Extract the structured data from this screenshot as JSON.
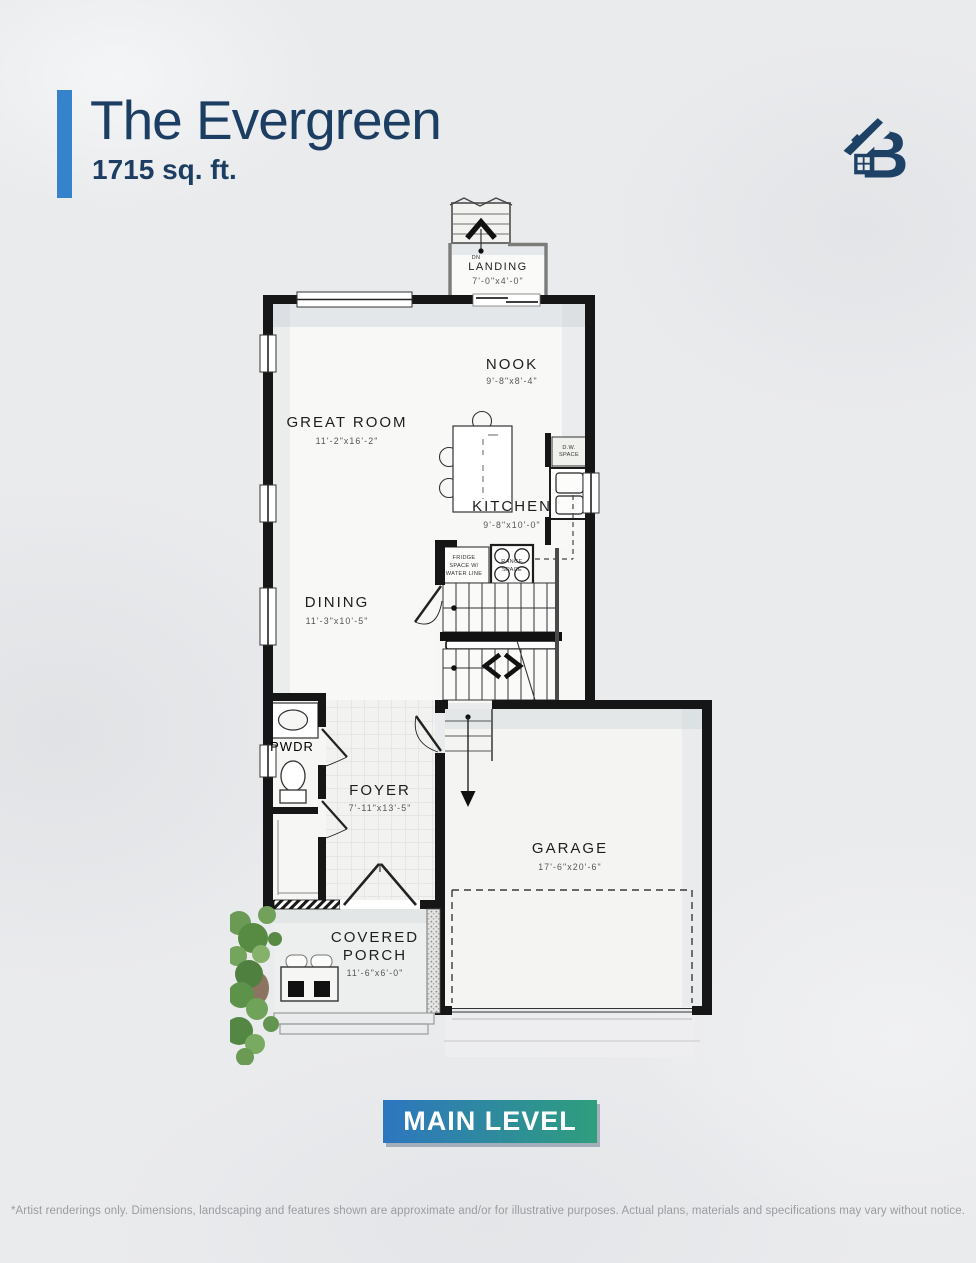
{
  "header": {
    "title": "The Evergreen",
    "sqft": "1715 sq. ft."
  },
  "logo": {
    "letter": "B",
    "description": "house-roof-b-logo"
  },
  "plan": {
    "rooms": {
      "landing": {
        "name": "LANDING",
        "dims": "7'-0\"x4'-0\""
      },
      "nook": {
        "name": "NOOK",
        "dims": "9'-8\"x8'-4\""
      },
      "great_room": {
        "name": "GREAT ROOM",
        "dims": "11'-2\"x16'-2\""
      },
      "kitchen": {
        "name": "KITCHEN",
        "dims": "9'-8\"x10'-0\""
      },
      "dining": {
        "name": "DINING",
        "dims": "11'-3\"x10'-5\""
      },
      "pwdr": {
        "name": "PWDR"
      },
      "foyer": {
        "name": "FOYER",
        "dims": "7'-11\"x13'-5\""
      },
      "garage": {
        "name": "GARAGE",
        "dims": "17'-6\"x20'-6\""
      },
      "covered_porch": {
        "line1": "COVERED",
        "line2": "PORCH",
        "dims": "11'-6\"x6'-0\""
      }
    },
    "annotations": {
      "dn": "DN",
      "dw_line1": "D.W.",
      "dw_line2": "SPACE",
      "fridge_line1": "FRIDGE",
      "fridge_line2": "SPACE W/",
      "fridge_line3": "WATER LINE",
      "range_line1": "RANGE",
      "range_line2": "SPACE"
    }
  },
  "badge": {
    "label": "MAIN LEVEL"
  },
  "footer": {
    "disclaimer": "*Artist renderings only. Dimensions, landscaping and features shown are approximate and/or for illustrative purposes. Actual plans, materials and specifications may vary without notice."
  },
  "colors": {
    "navy": "#1c3e63",
    "accent_blue": "#3583cb",
    "badge_gradient_start": "#2d76c0",
    "badge_gradient_end": "#2f9e7d",
    "wall_black": "#161616",
    "disclaimer_gray": "#9a9ca0"
  }
}
